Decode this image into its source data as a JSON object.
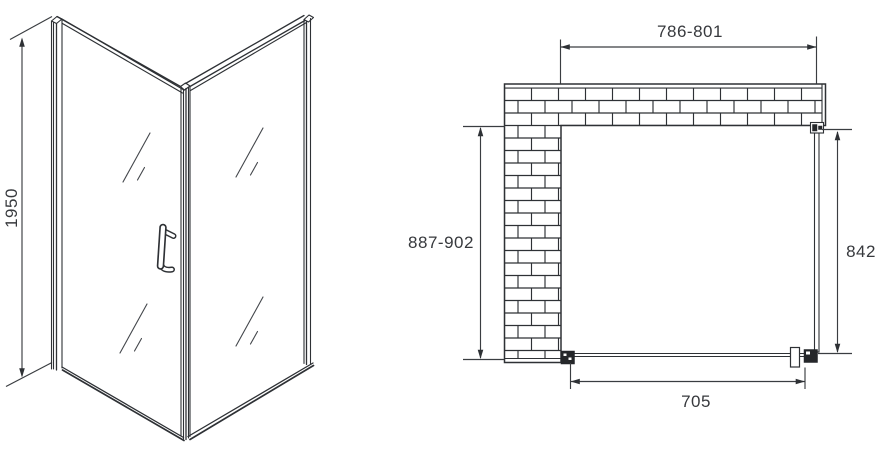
{
  "diagram": {
    "background_color": "#ffffff",
    "line_color": "#2e3135",
    "text_color": "#37393d",
    "isometric_view": {
      "height_label": "1950"
    },
    "plan_view": {
      "opening_width_label": "786-801",
      "depth_label": "887-902",
      "side_panel_label": "842",
      "door_width_label": "705"
    }
  }
}
